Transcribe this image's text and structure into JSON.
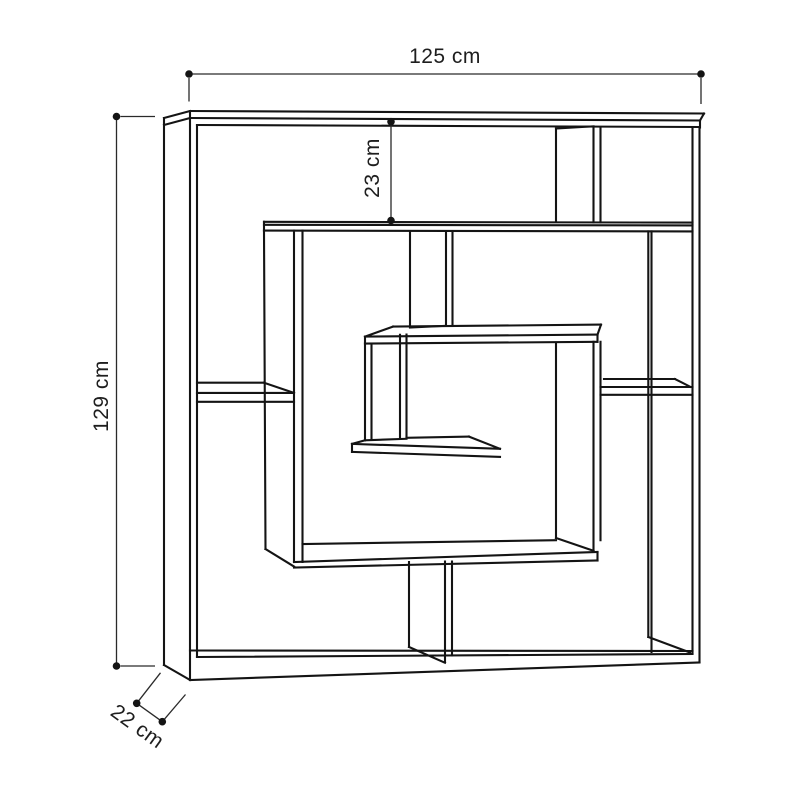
{
  "diagram": {
    "type": "furniture-dimension-drawing",
    "subject": "labyrinth-maze bookshelf line drawing",
    "dimensions": {
      "width_label": "125 cm",
      "height_label": "129 cm",
      "top_section_label": "23 cm",
      "depth_label": "22 cm"
    },
    "colors": {
      "line": "#141414",
      "dim_line": "#2a2a2a",
      "text": "#1e1e1e",
      "background": "#ffffff"
    }
  }
}
